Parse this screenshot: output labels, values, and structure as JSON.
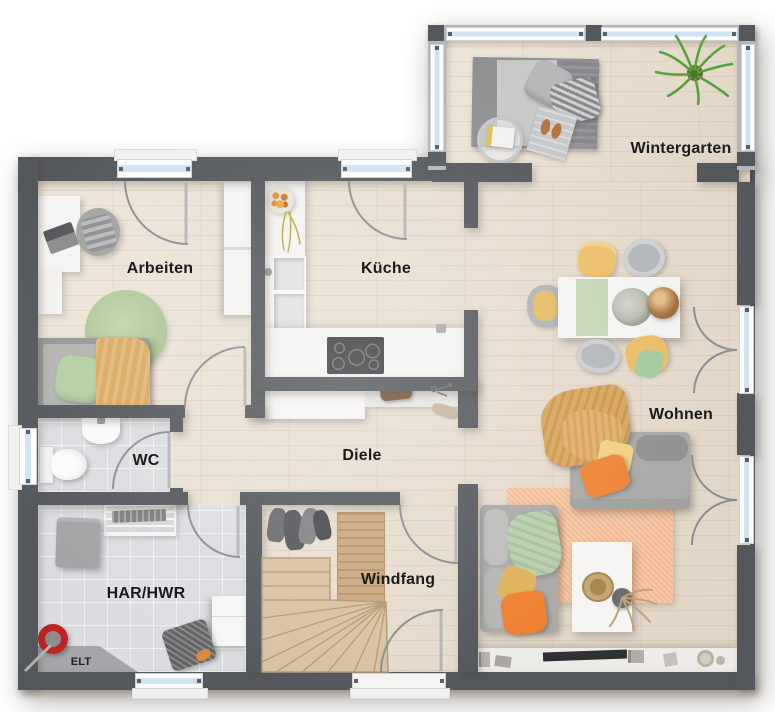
{
  "rooms": [
    {
      "id": "wintergarten",
      "label": "Wintergarten"
    },
    {
      "id": "arbeiten",
      "label": "Arbeiten"
    },
    {
      "id": "kueche",
      "label": "Küche"
    },
    {
      "id": "wohnen",
      "label": "Wohnen"
    },
    {
      "id": "diele",
      "label": "Diele"
    },
    {
      "id": "wc",
      "label": "WC"
    },
    {
      "id": "har-hwr",
      "label": "HAR/HWR"
    },
    {
      "id": "windfang",
      "label": "Windfang"
    },
    {
      "id": "elt",
      "label": "ELT"
    }
  ],
  "colors": {
    "wall": "#54585c",
    "frame": "#b3b6b9",
    "wood": "#e8dccb",
    "tile": "#dcdde0",
    "glass": "#cfe3f2",
    "stairs": "#d9c2a2",
    "sofa": "#a9a9a7",
    "orange": "#ee8335",
    "yellow": "#ecc06a",
    "green": "#b5cfa4",
    "rug_orange": "#f3ba92"
  }
}
